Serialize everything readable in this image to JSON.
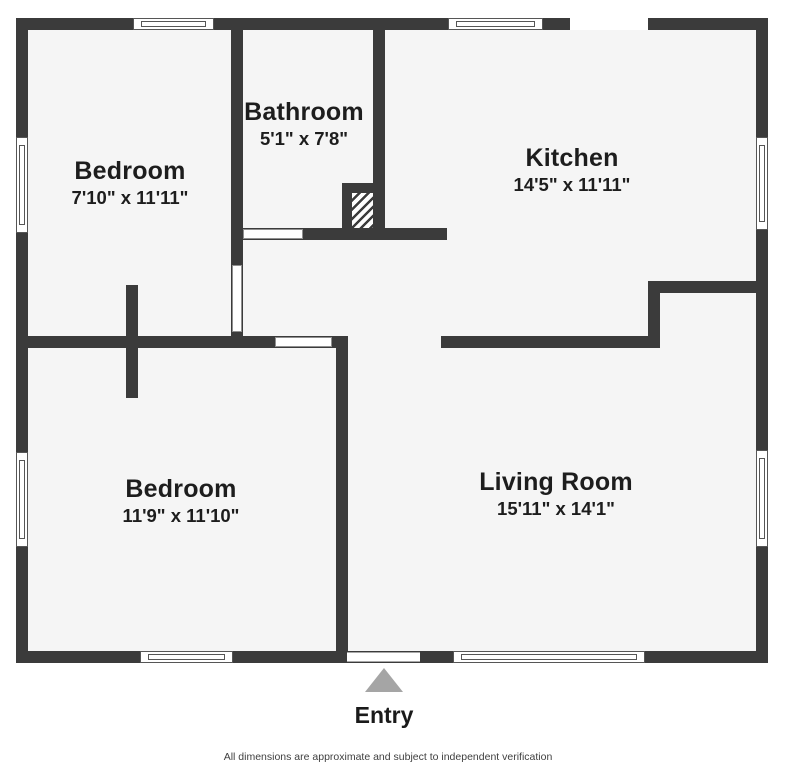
{
  "rooms": [
    {
      "name": "Bedroom",
      "dims": "7'10\" x 11'11\""
    },
    {
      "name": "Bathroom",
      "dims": "5'1\" x 7'8\""
    },
    {
      "name": "Kitchen",
      "dims": "14'5\" x 11'11\""
    },
    {
      "name": "Bedroom",
      "dims": "11'9\" x 11'10\""
    },
    {
      "name": "Living Room",
      "dims": "15'11\" x 14'1\""
    }
  ],
  "entry": {
    "label": "Entry"
  },
  "footer": {
    "disclaimer": "All dimensions are approximate and subject to independent verification"
  },
  "icons": {
    "entry_marker": "triangle-up"
  },
  "colors": {
    "wall": "#3b3b3b",
    "floor": "#f5f5f5",
    "entry_triangle": "#a5a5a5"
  }
}
